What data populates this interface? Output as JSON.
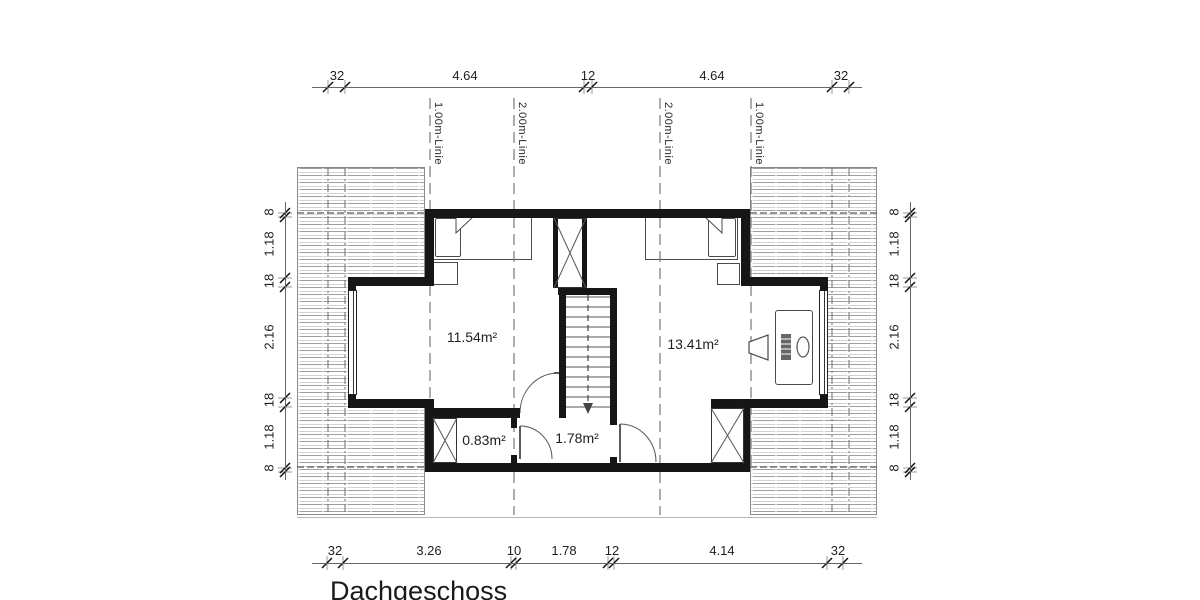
{
  "title": "Dachgeschoss",
  "rooms": [
    {
      "name": "bedroom-left",
      "area": "11.54m²"
    },
    {
      "name": "bedroom-right",
      "area": "13.41m²"
    },
    {
      "name": "closet",
      "area": "0.83m²"
    },
    {
      "name": "hallway",
      "area": "1.78m²"
    }
  ],
  "guide_lines": [
    "1.00m-Linie",
    "2.00m-Linie",
    "2.00m-Linie",
    "1.00m-Linie"
  ],
  "dimensions": {
    "top": [
      "32",
      "4.64",
      "12",
      "4.64",
      "32"
    ],
    "bottom": [
      "32",
      "3.26",
      "10",
      "1.78",
      "12",
      "4.14",
      "32"
    ],
    "left": [
      "8",
      "1.18",
      "18",
      "2.16",
      "18",
      "1.18",
      "8"
    ],
    "right": [
      "8",
      "1.18",
      "18",
      "2.16",
      "18",
      "1.18",
      "8"
    ]
  },
  "colors": {
    "wall": "#161616",
    "dim_text": "#1f1f1f",
    "hatch_line": "#9e9e9e"
  }
}
